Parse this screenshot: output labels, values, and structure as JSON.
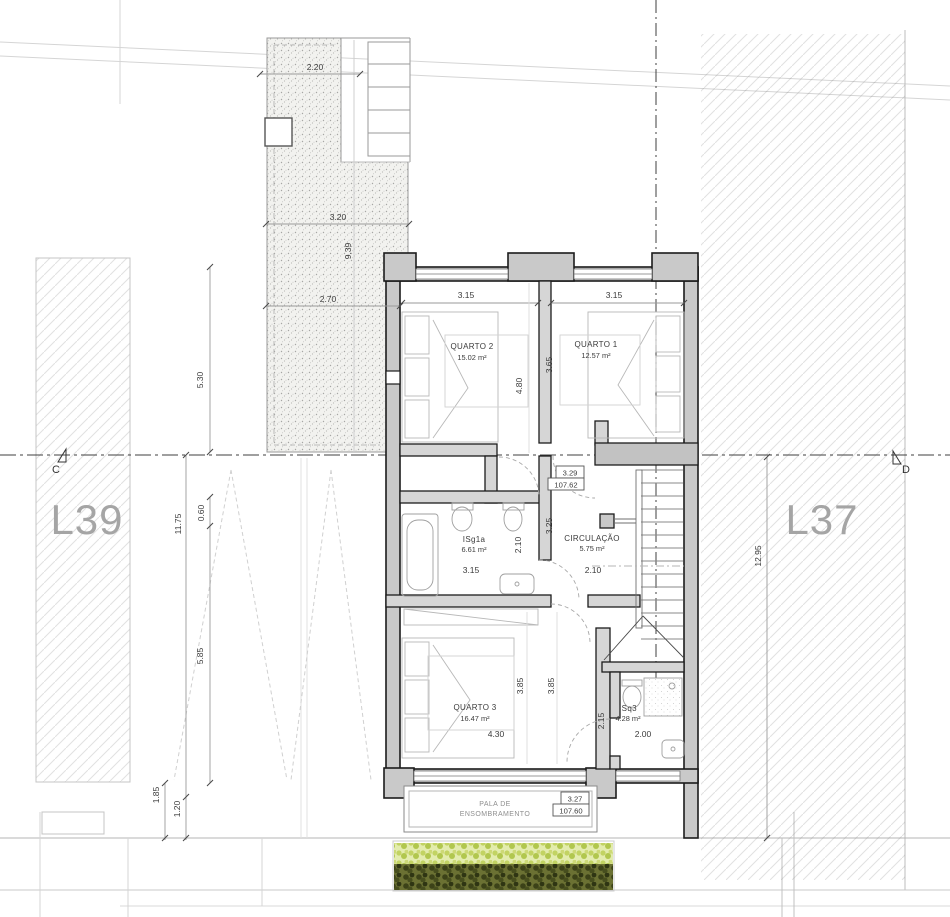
{
  "lots": {
    "left": "L39",
    "right": "L37"
  },
  "markers": {
    "left": "C",
    "right": "D"
  },
  "rooms": {
    "quarto2": {
      "name": "QUARTO 2",
      "area": "15.02 m²"
    },
    "quarto1": {
      "name": "QUARTO 1",
      "area": "12.57 m²"
    },
    "isg1a": {
      "name": "ISg1a",
      "area": "6.61 m²"
    },
    "circulacao": {
      "name": "CIRCULAÇÃO",
      "area": "5.75 m²"
    },
    "quarto3": {
      "name": "QUARTO 3",
      "area": "16.47 m²"
    },
    "isq3": {
      "name": "ISq3",
      "area": "4.28 m²"
    },
    "pala": {
      "line1": "PALA DE",
      "line2": "ENSOMBRAMENTO"
    }
  },
  "levels": {
    "upper": {
      "value": "3.29",
      "elevation": "107.62"
    },
    "lower": {
      "value": "3.27",
      "elevation": "107.60"
    }
  },
  "dims": {
    "terrace_top": "2.20",
    "terrace_mid": "3.20",
    "terrace_low": "2.70",
    "terrace_height": "9.39",
    "q2_width": "3.15",
    "q2_depth": "4.80",
    "q1_width": "3.15",
    "q1_depth": "3.65",
    "bath_width": "3.15",
    "bath_depth": "2.10",
    "circ_width": "2.10",
    "circ_depth": "3.25",
    "q3_width": "4.30",
    "q3_depth_a": "3.85",
    "q3_depth_b": "3.85",
    "isq3_width": "2.00",
    "isq3_depth": "2.15",
    "left_upper": "5.30",
    "left_offset": "0.60",
    "left_total": "11.75",
    "left_lower": "5.85",
    "left_bottom_a": "1.85",
    "left_bottom_b": "1.20",
    "right_total": "12.95"
  },
  "colors": {
    "wall_fill": "#c9c9c9",
    "veg_light": "#c2d363",
    "veg_dark": "#3f4519",
    "lot_label": "#a5a5a5"
  }
}
